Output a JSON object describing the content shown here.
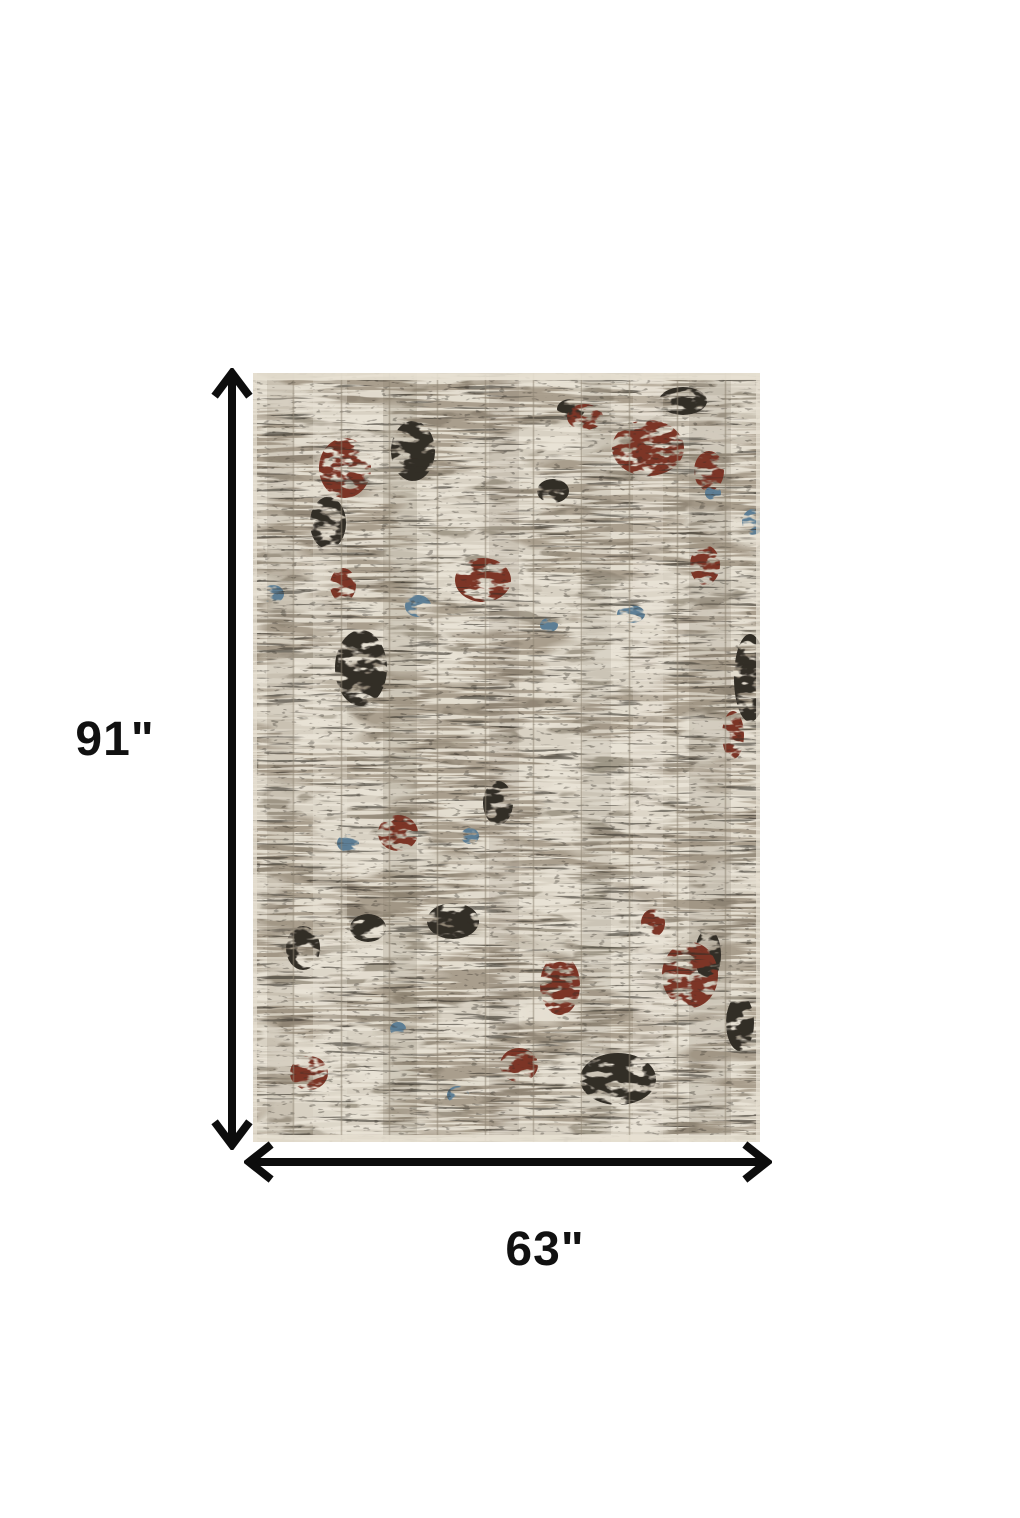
{
  "page": {
    "background": "#ffffff"
  },
  "dimensions": {
    "height_label": "91\"",
    "width_label": "63\"",
    "arrow_color": "#0d0d0d"
  },
  "rug": {
    "description": "abstract distressed area rug, ivory and taupe with rust, blue and charcoal accents",
    "palette": {
      "base_ivory": "#d8d1c3",
      "light_ivory": "#eae4d7",
      "taupe": "#a79c8b",
      "gray_brown": "#837969",
      "charcoal": "#322d27",
      "rust_red": "#7b3528",
      "steel_blue": "#5d7e95",
      "line_gray": "#8f8574",
      "selvedge": "#e7e0d2"
    }
  }
}
